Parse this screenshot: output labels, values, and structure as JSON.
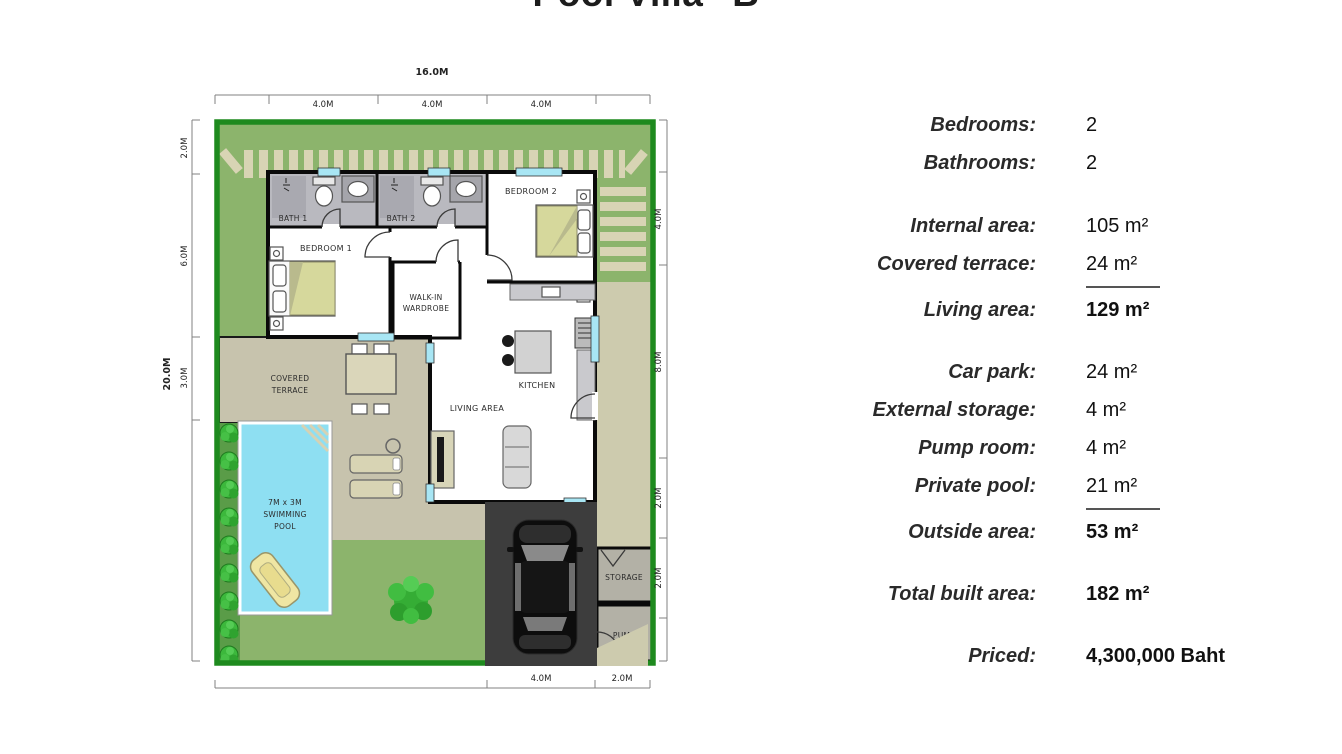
{
  "title": "Pool Villa \"B\"",
  "plan": {
    "colors": {
      "plot_border": "#1e8a1e",
      "lawn": "#8cb46c",
      "slat": "#d8d4b4",
      "beige": "#cdcbae",
      "deck": "#c7c3ad",
      "bush_strip": "#5a9c48",
      "pool": "#8edff2",
      "bath": "#b9b9bf",
      "shower": "#a9a9b0",
      "storage": "#b3b1a6",
      "carpark": "#3d3d3d",
      "window": "#a8e6f4",
      "bed": "#d6d89c",
      "bed_fold": "#b9ba8d",
      "bush": "#3cb83c",
      "tree": "#35ad35",
      "float": "#efe6a3",
      "counter": "#c9c9cd",
      "island": "#d2d2d2",
      "sofa": "#d8d8d8",
      "console": "#d8d5b8",
      "table": "#dad6ba",
      "wall": "#0a0a0a"
    },
    "dimensions": {
      "top_total": "16.0M",
      "top_segments": [
        "4.0M",
        "4.0M",
        "4.0M"
      ],
      "left_total": "20.0M",
      "left_segments": [
        "2.0M",
        "6.0M",
        "3.0M"
      ],
      "right_segments": [
        "4.0M",
        "8.0M",
        "2.0M",
        "2.0M"
      ],
      "bottom_segments": [
        "4.0M",
        "2.0M"
      ]
    },
    "rooms": {
      "bath1": "BATH 1",
      "bath2": "BATH 2",
      "bedroom1": "BEDROOM 1",
      "bedroom2": "BEDROOM 2",
      "wardrobe": [
        "WALK-IN",
        "WARDROBE"
      ],
      "kitchen": "KITCHEN",
      "living": "LIVING AREA",
      "terrace": [
        "COVERED",
        "TERRACE"
      ],
      "pool": [
        "7M x 3M",
        "SWIMMING",
        "POOL"
      ],
      "storage": "STORAGE",
      "pump": "PUMP"
    }
  },
  "specs": {
    "rows": [
      {
        "label": "Bedrooms:",
        "value": "2"
      },
      {
        "label": "Bathrooms:",
        "value": "2"
      },
      {
        "label": "Internal area:",
        "value": "105 m²"
      },
      {
        "label": "Covered terrace:",
        "value": "24 m²"
      },
      {
        "label": "Living area:",
        "value": "129 m²"
      },
      {
        "label": "Car park:",
        "value": "24 m²"
      },
      {
        "label": "External storage:",
        "value": "4 m²"
      },
      {
        "label": "Pump room:",
        "value": "4 m²"
      },
      {
        "label": "Private pool:",
        "value": "21 m²"
      },
      {
        "label": "Outside area:",
        "value": "53 m²"
      },
      {
        "label": "Total built area:",
        "value": "182 m²"
      },
      {
        "label": "Priced:",
        "value": "4,300,000 Baht"
      }
    ]
  }
}
